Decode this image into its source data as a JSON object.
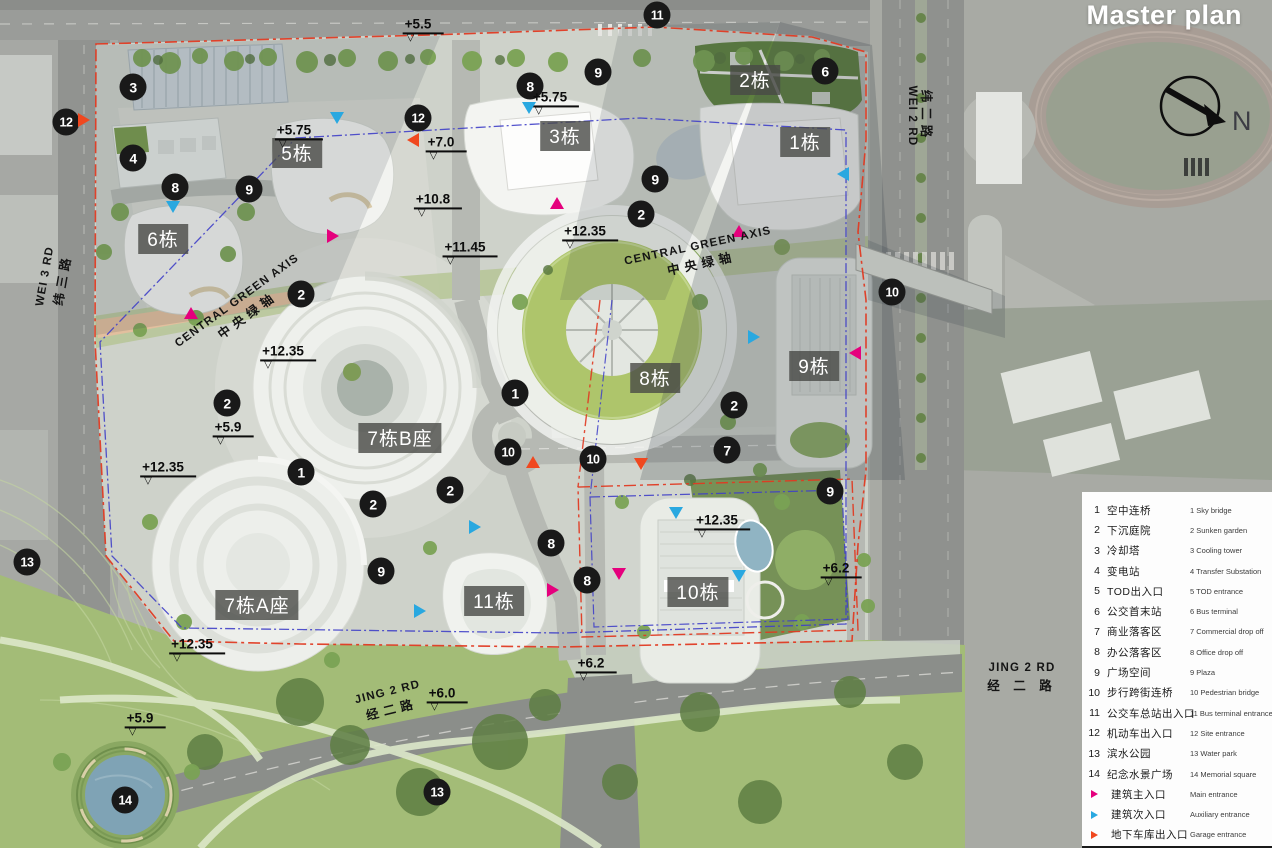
{
  "title": "Master plan",
  "compass": {
    "label": "N"
  },
  "colors": {
    "main": "#e5007d",
    "aux": "#29a8e0",
    "garage": "#f0481f"
  },
  "buildings": [
    {
      "label": "5栋",
      "x": 297,
      "y": 153
    },
    {
      "label": "6栋",
      "x": 163,
      "y": 239
    },
    {
      "label": "3栋",
      "x": 565,
      "y": 136
    },
    {
      "label": "2栋",
      "x": 755,
      "y": 80
    },
    {
      "label": "1栋",
      "x": 805,
      "y": 142
    },
    {
      "label": "8栋",
      "x": 655,
      "y": 378
    },
    {
      "label": "9栋",
      "x": 814,
      "y": 366
    },
    {
      "label": "7栋B座",
      "x": 400,
      "y": 438
    },
    {
      "label": "7栋A座",
      "x": 257,
      "y": 605
    },
    {
      "label": "11栋",
      "x": 494,
      "y": 601
    },
    {
      "label": "10栋",
      "x": 698,
      "y": 592
    }
  ],
  "markers": [
    {
      "n": "3",
      "x": 133,
      "y": 87
    },
    {
      "n": "12",
      "x": 66,
      "y": 122
    },
    {
      "n": "4",
      "x": 133,
      "y": 158
    },
    {
      "n": "8",
      "x": 175,
      "y": 187
    },
    {
      "n": "9",
      "x": 249,
      "y": 189
    },
    {
      "n": "12",
      "x": 418,
      "y": 118
    },
    {
      "n": "8",
      "x": 530,
      "y": 86
    },
    {
      "n": "9",
      "x": 598,
      "y": 72
    },
    {
      "n": "11",
      "x": 657,
      "y": 15
    },
    {
      "n": "6",
      "x": 825,
      "y": 71
    },
    {
      "n": "9",
      "x": 655,
      "y": 179
    },
    {
      "n": "2",
      "x": 641,
      "y": 214
    },
    {
      "n": "2",
      "x": 301,
      "y": 294
    },
    {
      "n": "10",
      "x": 892,
      "y": 292
    },
    {
      "n": "2",
      "x": 227,
      "y": 403
    },
    {
      "n": "1",
      "x": 301,
      "y": 472
    },
    {
      "n": "2",
      "x": 373,
      "y": 504
    },
    {
      "n": "2",
      "x": 450,
      "y": 490
    },
    {
      "n": "1",
      "x": 515,
      "y": 393
    },
    {
      "n": "10",
      "x": 508,
      "y": 452
    },
    {
      "n": "10",
      "x": 593,
      "y": 459
    },
    {
      "n": "2",
      "x": 734,
      "y": 405
    },
    {
      "n": "7",
      "x": 727,
      "y": 450
    },
    {
      "n": "9",
      "x": 381,
      "y": 571
    },
    {
      "n": "8",
      "x": 551,
      "y": 543
    },
    {
      "n": "8",
      "x": 587,
      "y": 580
    },
    {
      "n": "9",
      "x": 830,
      "y": 491
    },
    {
      "n": "13",
      "x": 27,
      "y": 562
    },
    {
      "n": "14",
      "x": 125,
      "y": 800
    },
    {
      "n": "13",
      "x": 437,
      "y": 792
    }
  ],
  "elevations": [
    {
      "label": "+5.5",
      "x": 423,
      "y": 25
    },
    {
      "label": "+5.75",
      "x": 299,
      "y": 131
    },
    {
      "label": "+5.75",
      "x": 555,
      "y": 98
    },
    {
      "label": "+7.0",
      "x": 446,
      "y": 143
    },
    {
      "label": "+10.8",
      "x": 438,
      "y": 200
    },
    {
      "label": "+11.45",
      "x": 470,
      "y": 248
    },
    {
      "label": "+12.35",
      "x": 590,
      "y": 232
    },
    {
      "label": "+12.35",
      "x": 288,
      "y": 352
    },
    {
      "label": "+12.35",
      "x": 168,
      "y": 468
    },
    {
      "label": "+5.9",
      "x": 233,
      "y": 428
    },
    {
      "label": "+12.35",
      "x": 197,
      "y": 645
    },
    {
      "label": "+12.35",
      "x": 722,
      "y": 521
    },
    {
      "label": "+6.2",
      "x": 841,
      "y": 569
    },
    {
      "label": "+6.2",
      "x": 596,
      "y": 664
    },
    {
      "label": "+6.0",
      "x": 447,
      "y": 694
    },
    {
      "label": "+5.9",
      "x": 145,
      "y": 719
    }
  ],
  "entrances": [
    {
      "type": "main",
      "x": 333,
      "y": 236,
      "dir": "right"
    },
    {
      "type": "main",
      "x": 191,
      "y": 313,
      "dir": "up"
    },
    {
      "type": "main",
      "x": 557,
      "y": 203,
      "dir": "up"
    },
    {
      "type": "main",
      "x": 739,
      "y": 231,
      "dir": "up"
    },
    {
      "type": "main",
      "x": 855,
      "y": 353,
      "dir": "left"
    },
    {
      "type": "main",
      "x": 619,
      "y": 574,
      "dir": "down"
    },
    {
      "type": "main",
      "x": 553,
      "y": 590,
      "dir": "right"
    },
    {
      "type": "aux",
      "x": 337,
      "y": 118,
      "dir": "down"
    },
    {
      "type": "aux",
      "x": 173,
      "y": 207,
      "dir": "down"
    },
    {
      "type": "aux",
      "x": 529,
      "y": 108,
      "dir": "down"
    },
    {
      "type": "aux",
      "x": 843,
      "y": 174,
      "dir": "left"
    },
    {
      "type": "aux",
      "x": 754,
      "y": 337,
      "dir": "right"
    },
    {
      "type": "aux",
      "x": 475,
      "y": 527,
      "dir": "right"
    },
    {
      "type": "aux",
      "x": 420,
      "y": 611,
      "dir": "right"
    },
    {
      "type": "aux",
      "x": 676,
      "y": 513,
      "dir": "down"
    },
    {
      "type": "aux",
      "x": 739,
      "y": 576,
      "dir": "down"
    },
    {
      "type": "garage",
      "x": 84,
      "y": 120,
      "dir": "right"
    },
    {
      "type": "garage",
      "x": 413,
      "y": 140,
      "dir": "left"
    },
    {
      "type": "garage",
      "x": 533,
      "y": 462,
      "dir": "up"
    },
    {
      "type": "garage",
      "x": 641,
      "y": 464,
      "dir": "down"
    }
  ],
  "map_labels": [
    {
      "kind": "road",
      "lines": [
        [
          "WEI 3 RD",
          "en"
        ],
        [
          "纬三路",
          "zh"
        ]
      ],
      "x": 55,
      "y": 278,
      "rot": -80
    },
    {
      "kind": "road",
      "lines": [
        [
          "纬二路",
          "zh"
        ],
        [
          "WEI 2 RD",
          "en"
        ]
      ],
      "x": 922,
      "y": 116,
      "rot": 90
    },
    {
      "kind": "road",
      "lines": [
        [
          "JING 2 RD",
          "en"
        ],
        [
          "经二路",
          "zh"
        ]
      ],
      "x": 390,
      "y": 702,
      "rot": -14
    },
    {
      "kind": "road",
      "lines": [
        [
          "JING 2 RD",
          "en"
        ],
        [
          "经 二 路",
          "zh"
        ]
      ],
      "x": 1022,
      "y": 678,
      "rot": 0
    },
    {
      "kind": "axis",
      "lines": [
        [
          "CENTRAL GREEN AXIS",
          "en"
        ],
        [
          "中央绿轴",
          "zh"
        ]
      ],
      "x": 243,
      "y": 309,
      "rot": -36
    },
    {
      "kind": "axis",
      "lines": [
        [
          "CENTRAL GREEN AXIS",
          "en"
        ],
        [
          "中央绿轴",
          "zh"
        ]
      ],
      "x": 700,
      "y": 256,
      "rot": -12
    }
  ],
  "legend": {
    "items": [
      {
        "num": "1",
        "zh": "空中连桥",
        "en": "Sky bridge"
      },
      {
        "num": "2",
        "zh": "下沉庭院",
        "en": "Sunken garden"
      },
      {
        "num": "3",
        "zh": "冷却塔",
        "en": "Cooling tower"
      },
      {
        "num": "4",
        "zh": "变电站",
        "en": "Transfer Substation"
      },
      {
        "num": "5",
        "zh": "TOD出入口",
        "en": "TOD entrance"
      },
      {
        "num": "6",
        "zh": "公交首末站",
        "en": "Bus terminal"
      },
      {
        "num": "7",
        "zh": "商业落客区",
        "en": "Commercial drop off"
      },
      {
        "num": "8",
        "zh": "办公落客区",
        "en": "Office drop off"
      },
      {
        "num": "9",
        "zh": "广场空间",
        "en": "Plaza"
      },
      {
        "num": "10",
        "zh": "步行跨街连桥",
        "en": "Pedestrian bridge"
      },
      {
        "num": "11",
        "zh": "公交车总站出入口",
        "en": "Bus terminal entrance"
      },
      {
        "num": "12",
        "zh": "机动车出入口",
        "en": "Site entrance"
      },
      {
        "num": "13",
        "zh": "滨水公园",
        "en": "Water park"
      },
      {
        "num": "14",
        "zh": "纪念水景广场",
        "en": "Memorial square"
      }
    ],
    "entrance_items": [
      {
        "type": "main",
        "zh": "建筑主入口",
        "en": "Main entrance"
      },
      {
        "type": "aux",
        "zh": "建筑次入口",
        "en": "Auxiliary entrance"
      },
      {
        "type": "garage",
        "zh": "地下车库出入口",
        "en": "Garage entrance"
      }
    ]
  }
}
